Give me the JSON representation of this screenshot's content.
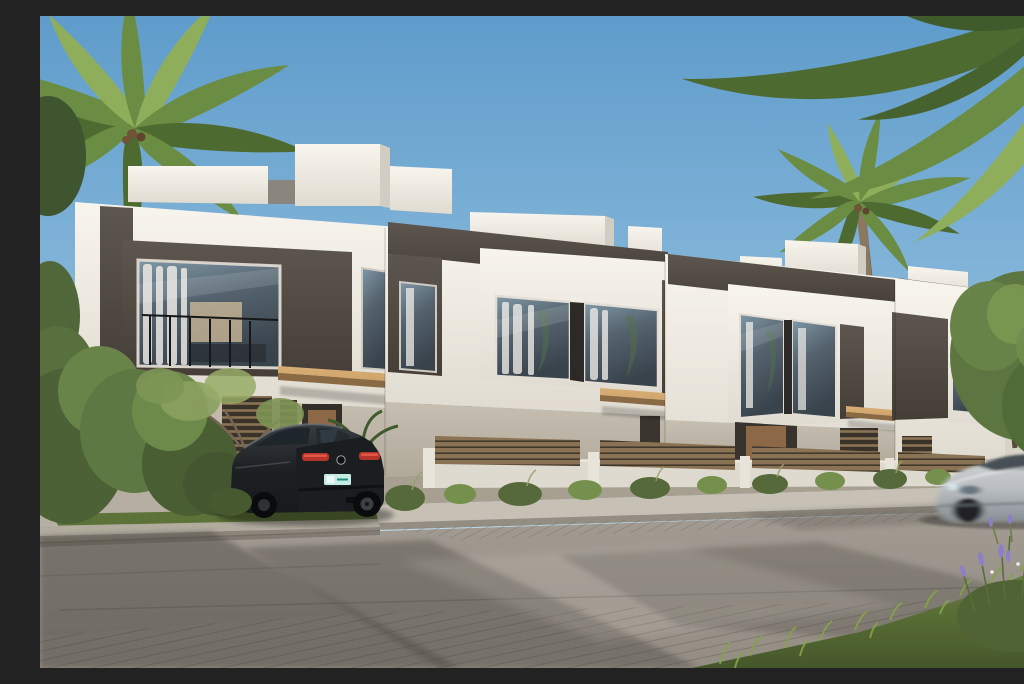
{
  "meta": {
    "title": "Townhouse exterior render",
    "description": "Sunny architectural rendering of a row of modern two-storey townhouses in white and dark grey stucco with wooden canopies and slat fences, coconut palm trees, a black SUV parked in a driveway with a teal license plate, a motion-blurred silver car passing on the street, and grass with lavender in the foreground."
  },
  "scene": {
    "objects": [
      {
        "id": "sky",
        "label": "Clear blue sky"
      },
      {
        "id": "palm-left",
        "label": "Coconut palm tree, upper left"
      },
      {
        "id": "palm-right",
        "label": "Coconut palm tree behind the townhouses"
      },
      {
        "id": "palm-corner",
        "label": "Palm fronds overhanging the top right corner"
      },
      {
        "id": "townhouses",
        "label": "Row of modern white and dark grey townhouses with large windows"
      },
      {
        "id": "fences",
        "label": "Wooden slat garden fences on low white walls"
      },
      {
        "id": "shrubs",
        "label": "Ornamental shrubs along the garden wall"
      },
      {
        "id": "tree-right",
        "label": "Green tree at the right end of the row"
      },
      {
        "id": "suv",
        "label": "Black luxury SUV parked in the driveway"
      },
      {
        "id": "plate",
        "label": "Teal and white license plate"
      },
      {
        "id": "car-silver",
        "label": "Silver car driving past, motion blurred"
      },
      {
        "id": "street",
        "label": "Concrete street with paver strips and tree shadows"
      },
      {
        "id": "grass",
        "label": "Foreground grass and lavender, bottom right"
      }
    ]
  },
  "colors": {
    "sky_top": "#5f9ccb",
    "sky_mid": "#8fbddd",
    "sky_low": "#c9e0ed",
    "facade_white": "#f1eee6",
    "facade_bright": "#f8f5ee",
    "facade_shade": "#d2cdc2",
    "dark_panel": "#5d564e",
    "dark_panel_deep": "#453e37",
    "stucco": "#c6bfb2",
    "stucco_shade": "#b0a898",
    "wood": "#c89e66",
    "wood_dark": "#8a6a45",
    "door_wood": "#8d6847",
    "fence_wood": "#8a7354",
    "fence_gap": "#42392c",
    "glass_dark": "#39434c",
    "glass_light": "#7f97a6",
    "curtain": "#f0ede8",
    "frame_dark": "#24221f",
    "wall_white": "#dedad0",
    "sidewalk": "#c7c1b5",
    "apron": "#b5aea1",
    "road_light": "#a39c93",
    "road_dark": "#8e8880",
    "road_shadow": "#4a463f",
    "grass_green": "#5d7238",
    "grass_light": "#86a14b",
    "bush": "#55693a",
    "bush_light": "#74904c",
    "palm": "#6b8c43",
    "palm_dark": "#4d6a31",
    "palm_light": "#8fae5b",
    "trunk": "#8a7861",
    "tree": "#5d7540",
    "car_black": "#17191b",
    "car_black_hi": "#383c40",
    "car_silver": "#b7bcc0",
    "car_silver_dark": "#878d93",
    "plate_teal": "#c6ebe2",
    "plate_text": "#1f8f85",
    "tail_red": "#b5352a",
    "tail_red_hi": "#e2564a",
    "lavender": "#8d7fc7"
  }
}
